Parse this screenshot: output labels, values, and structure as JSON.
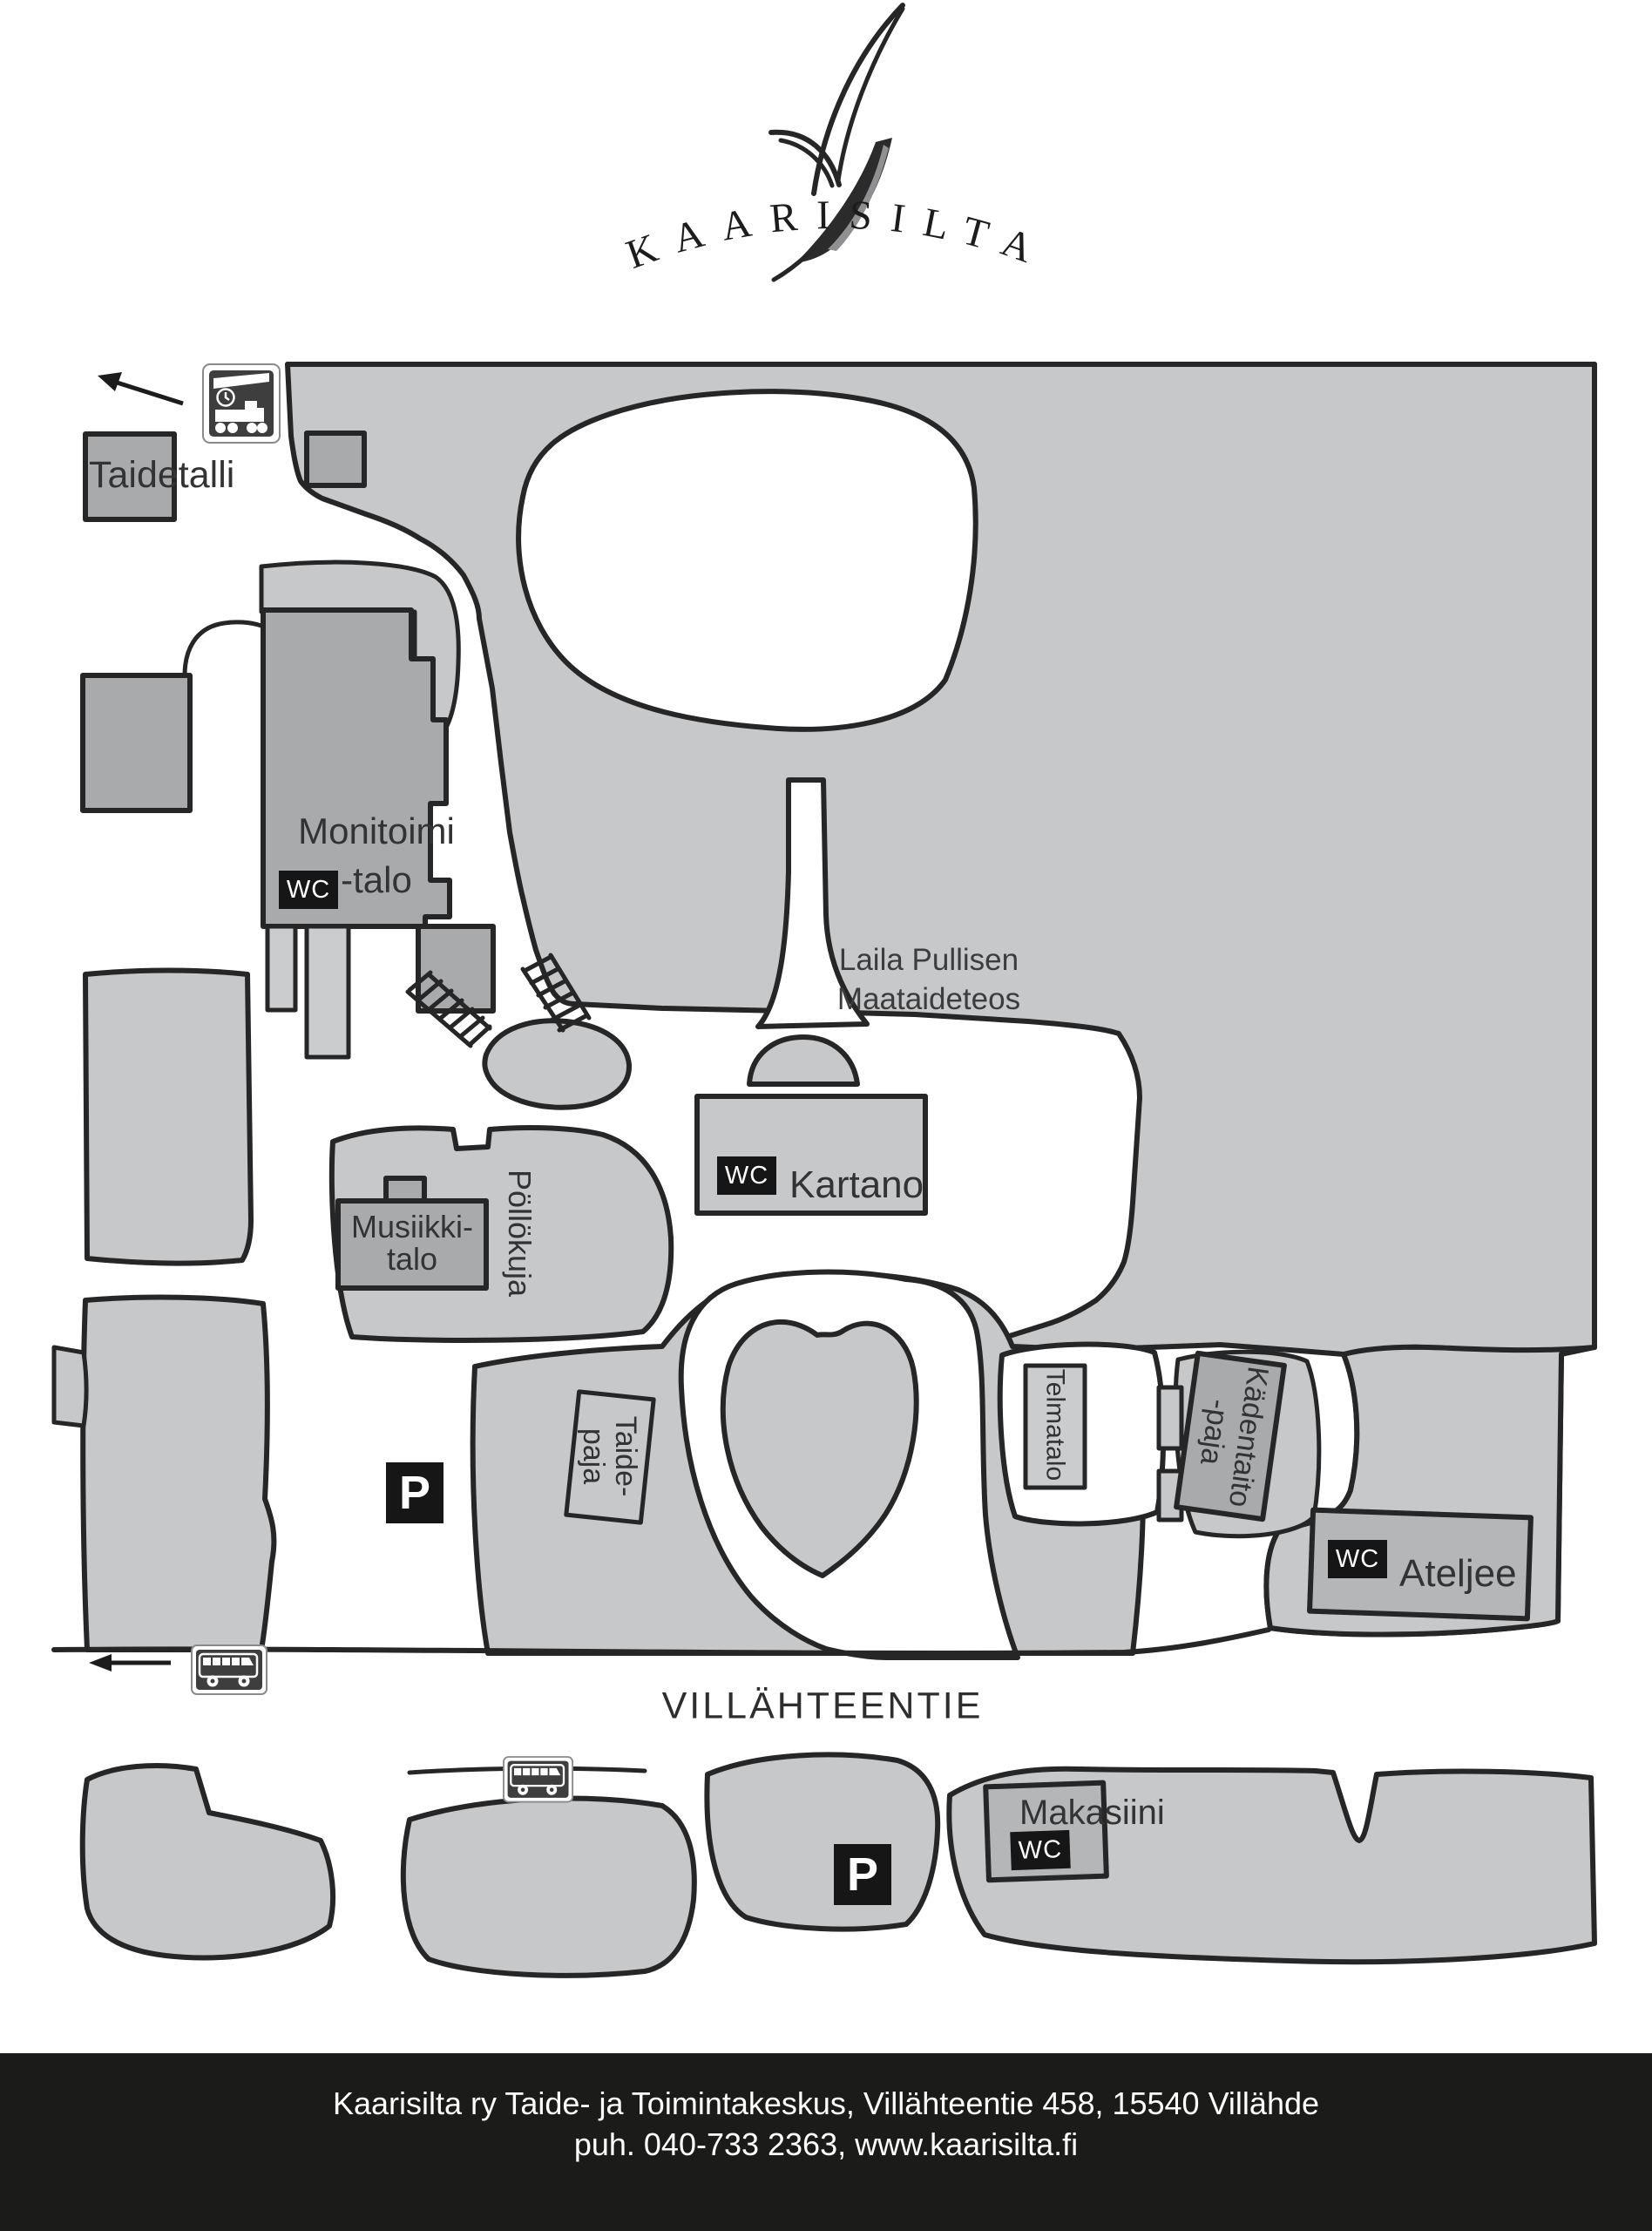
{
  "logo": {
    "text": "KAARISILTA"
  },
  "map": {
    "labels": {
      "taidetalli": "Taidetalli",
      "monitoimi_line1": "Monitoimi",
      "monitoimi_line2": "-talo",
      "laila_line1": "Laila Pullisen",
      "laila_line2": "Maataideteos",
      "kartano": "Kartano",
      "musiikki_line1": "Musiikki-",
      "musiikki_line2": "talo",
      "pollokuja": "Pöllökuja",
      "taidepaja_line1": "Taide-",
      "taidepaja_line2": "paja",
      "telmatalo": "Telmatalo",
      "kadentaito_line1": "Kädentaito",
      "kadentaito_line2": "-paja",
      "ateljee": "Ateljee",
      "makasiini": "Makasiini",
      "villahteentie": "VILLÄHTEENTIE"
    },
    "badges": {
      "wc": "WC",
      "parking": "P"
    },
    "icons": {
      "train": "train-station-sign",
      "bus": "bus-stop-sign",
      "arrow": "direction-arrow"
    }
  },
  "footer": {
    "line1": "Kaarisilta ry Taide- ja Toimintakeskus, Villähteentie 458, 15540 Villähde",
    "line2": "puh. 040-733 2363, www.kaarisilta.fi"
  },
  "colors": {
    "land": "#c7c8ca",
    "building_dark": "#a9aaac",
    "building_mid": "#b5b6b8",
    "building_light": "#cbccce",
    "outline": "#262626",
    "badge_bg": "#161616",
    "badge_text": "#ffffff",
    "sign_bg": "#3e3e3e",
    "footer_bg": "#1b1b19",
    "footer_text": "#ffffff"
  }
}
